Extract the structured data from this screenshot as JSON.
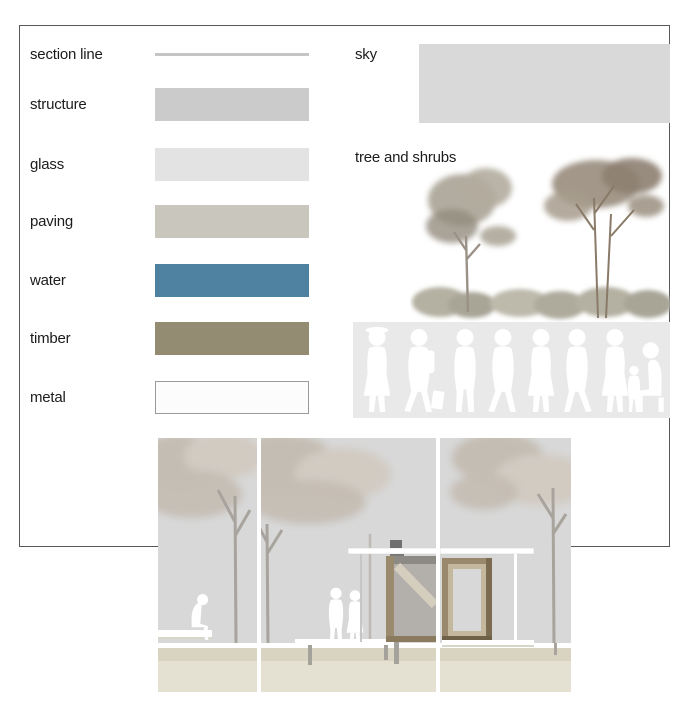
{
  "materials": {
    "items": [
      {
        "label": "section line",
        "color": "#c5c5c5",
        "kind": "line"
      },
      {
        "label": "structure",
        "color": "#cbcbcb",
        "kind": "fill"
      },
      {
        "label": "glass",
        "color": "#e3e3e4",
        "kind": "fill"
      },
      {
        "label": "paving",
        "color": "#c9c6be",
        "kind": "fill"
      },
      {
        "label": "water",
        "color": "#4f81a0",
        "kind": "fill"
      },
      {
        "label": "timber",
        "color": "#948b73",
        "kind": "fill"
      },
      {
        "label": "metal",
        "color": "#fcfcfd",
        "kind": "outlined",
        "border_color": "#9b9b9b"
      }
    ]
  },
  "environment": {
    "sky": {
      "label": "sky",
      "color": "#d9d9d9"
    },
    "trees": {
      "label": "tree and shrubs"
    }
  },
  "illustrations": {
    "people_strip_bg": "#e9e9e9",
    "silhouette_color": "#ffffff",
    "drawing": {
      "sky": "#d8d8d8",
      "canopy": "#c4bdb3",
      "canopy_light": "#d1cbc2",
      "trunk": "#a8a49d",
      "ground_upper": "#d9d4c1",
      "ground_lower": "#e4e1d3",
      "timber": "#9a8a6e",
      "timber_dark": "#8a7a5e",
      "structure_fill": "#b3b0ab"
    },
    "sample_trees": {
      "foliage_left": "#a9a395",
      "foliage_right": "#9d9183",
      "branch": "#8a7a68",
      "hedge": "#b4b1a2"
    },
    "frame_border": "#58595b"
  }
}
